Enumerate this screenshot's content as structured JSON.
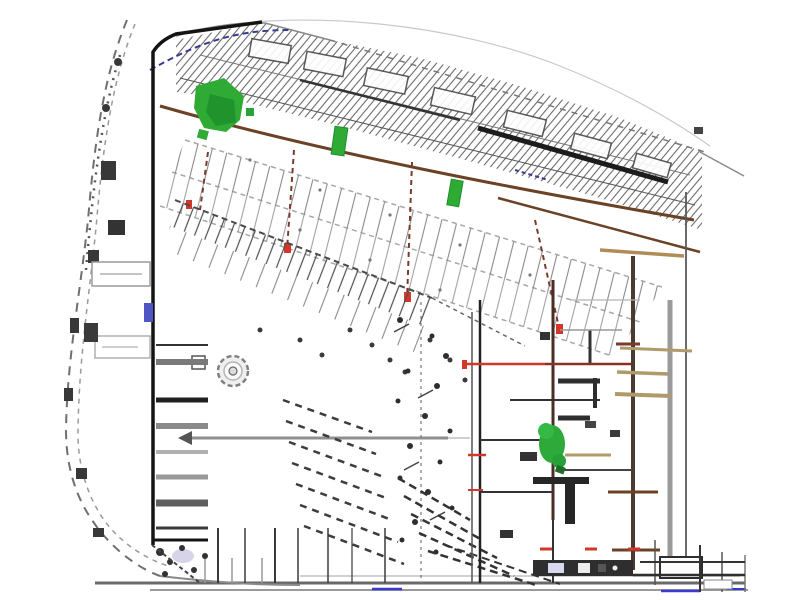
{
  "canvas": {
    "width": 800,
    "height": 600,
    "background": "#ffffff"
  },
  "drawing": {
    "kind": "architectural-site-plan",
    "colors": {
      "ink": "#141414",
      "line_dark": "#3d3d3d",
      "line_mid": "#6f6f6f",
      "line_light": "#a8a8a8",
      "line_faint": "#c9c9c9",
      "brown": "#6b4226",
      "maroon": "#7a3b2e",
      "tan": "#b08d57",
      "khaki": "#b09a6a",
      "red": "#d2372a",
      "red_dark": "#8a3226",
      "green": "#2faa35",
      "green_dark": "#1d8f2a",
      "green_mid": "#2daa3a",
      "navy": "#383a8c",
      "blue": "#3a3ad0",
      "blue_chip": "#4f55c4",
      "gray_road": "#6a6a6a",
      "lavender": "#c9c5e2",
      "tree_ring": "#808080",
      "tree_fill": "#efefef",
      "strip_dark": "#2e2e2e",
      "white": "#ffffff"
    },
    "features": [
      "perimeter-road-west",
      "south-road",
      "site-boundary",
      "north-street-band",
      "curb-lines",
      "upper-parking-field",
      "parking-row-dividers",
      "planting-green-northwest",
      "planting-green-row",
      "angled-stall-row",
      "tree-symbol",
      "west-parking-stalls",
      "landscape-strip",
      "diagonal-stripes-upper",
      "diagonal-stripes-lower",
      "bottom-stall-ticks",
      "east-building-complex",
      "green-island",
      "red-utility-line",
      "title-strip"
    ]
  }
}
